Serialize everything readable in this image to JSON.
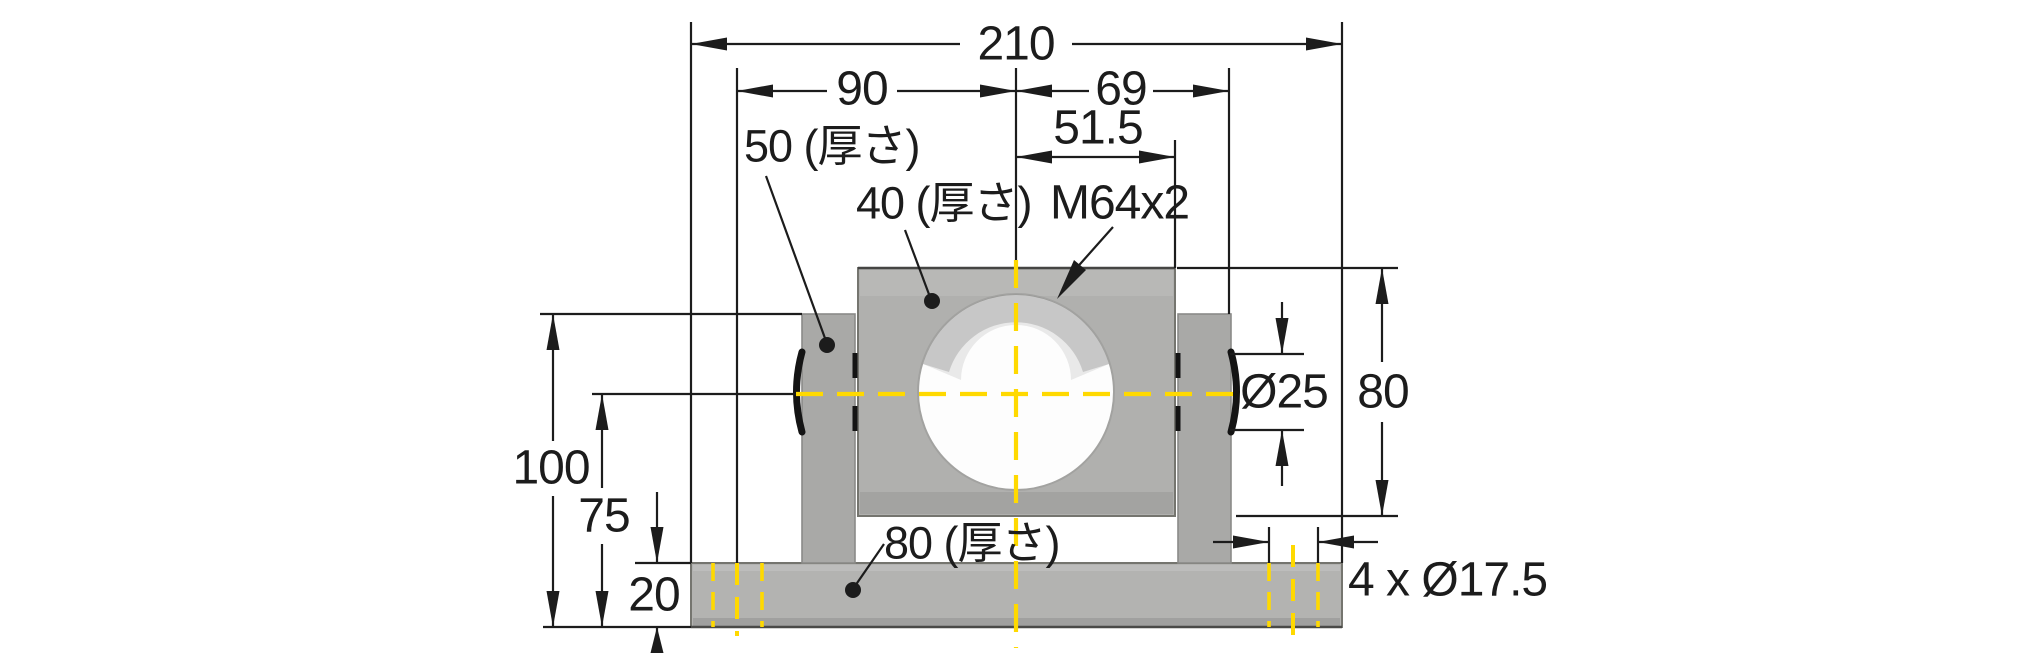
{
  "dims": {
    "overall_width": "210",
    "center_to_left_hole": "90",
    "center_to_right_face": "69",
    "center_to_block_edge": "51.5",
    "side_plate_thickness": "50 (厚さ)",
    "block_thickness": "40 (厚さ)",
    "thread_spec": "M64x2",
    "trunnion_diameter": "Ø25",
    "block_height": "80",
    "overall_height": "100",
    "center_height": "75",
    "base_plate_height": "20",
    "base_thickness": "80 (厚さ)",
    "mounting_holes": "4 x Ø17.5"
  },
  "colors": {
    "background": "#ffffff",
    "metal_gray_block": "#b0b0ae",
    "metal_gray_plate": "#a9a9a7",
    "metal_gray_base": "#b3b3b1",
    "centerline_yellow": "#ffd900",
    "line_black": "#1c1c1c"
  }
}
